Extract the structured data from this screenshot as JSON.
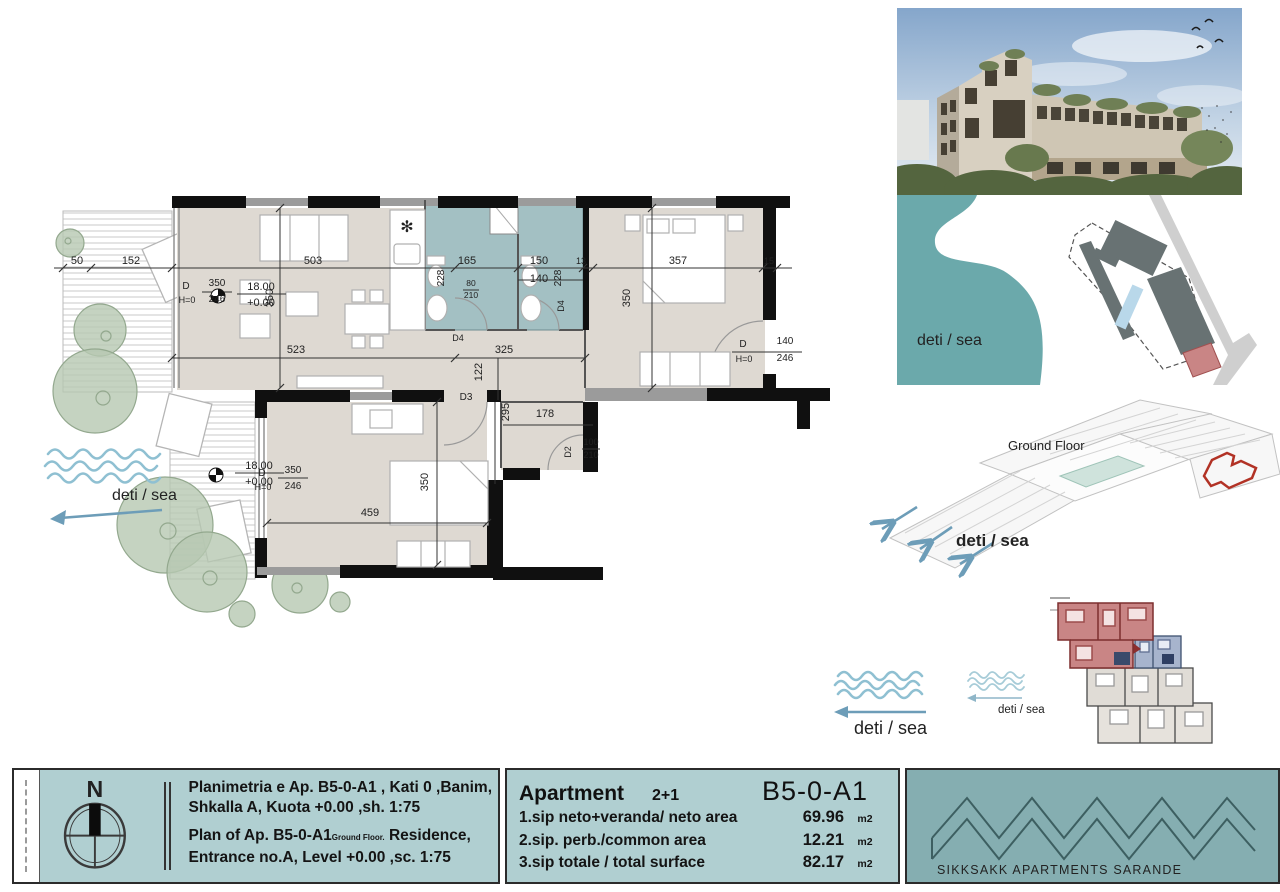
{
  "plan": {
    "deti_sea": "deti / sea",
    "dim_labels": [
      {
        "t": "50",
        "x": 37,
        "y": 78
      },
      {
        "t": "152",
        "x": 91,
        "y": 78
      },
      {
        "t": "503",
        "x": 273,
        "y": 78
      },
      {
        "t": "165",
        "x": 427,
        "y": 78
      },
      {
        "t": "228",
        "x": 404,
        "y": 92,
        "r": -90,
        "fs": 10
      },
      {
        "t": "150",
        "x": 499,
        "y": 78
      },
      {
        "t": "140",
        "x": 499,
        "y": 96
      },
      {
        "t": "228",
        "x": 521,
        "y": 92,
        "r": -90,
        "fs": 10
      },
      {
        "t": "13",
        "x": 541,
        "y": 78,
        "fs": 9
      },
      {
        "t": "357",
        "x": 638,
        "y": 78
      },
      {
        "t": "15",
        "x": 729,
        "y": 78,
        "fs": 9
      },
      {
        "t": "350",
        "x": 233,
        "y": 112,
        "r": -90
      },
      {
        "t": "350",
        "x": 590,
        "y": 112,
        "r": -90
      },
      {
        "t": "523",
        "x": 256,
        "y": 167
      },
      {
        "t": "325",
        "x": 464,
        "y": 167
      },
      {
        "t": "122",
        "x": 442,
        "y": 186,
        "r": -90
      },
      {
        "t": "295",
        "x": 469,
        "y": 226,
        "r": -90
      },
      {
        "t": "178",
        "x": 505,
        "y": 231
      },
      {
        "t": "459",
        "x": 330,
        "y": 330
      },
      {
        "t": "350",
        "x": 388,
        "y": 296,
        "r": -90
      },
      {
        "t": "18.00",
        "x": 221,
        "y": 104
      },
      {
        "t": "+0.00",
        "x": 221,
        "y": 120
      },
      {
        "t": "18.00",
        "x": 219,
        "y": 283
      },
      {
        "t": "+0.00",
        "x": 219,
        "y": 299
      },
      {
        "t": "D",
        "x": 146,
        "y": 103,
        "fs": 10
      },
      {
        "t": "350",
        "x": 177,
        "y": 100,
        "fs": 10
      },
      {
        "t": "H=0",
        "x": 147,
        "y": 117,
        "fs": 9
      },
      {
        "t": "246",
        "x": 177,
        "y": 116,
        "fs": 10
      },
      {
        "t": "D",
        "x": 222,
        "y": 290,
        "fs": 10
      },
      {
        "t": "350",
        "x": 253,
        "y": 287,
        "fs": 10
      },
      {
        "t": "H=0",
        "x": 223,
        "y": 304,
        "fs": 9
      },
      {
        "t": "246",
        "x": 253,
        "y": 303,
        "fs": 10
      },
      {
        "t": "D",
        "x": 703,
        "y": 161,
        "fs": 10
      },
      {
        "t": "140",
        "x": 745,
        "y": 158,
        "fs": 10
      },
      {
        "t": "H=0",
        "x": 704,
        "y": 176,
        "fs": 9
      },
      {
        "t": "246",
        "x": 745,
        "y": 175,
        "fs": 10
      },
      {
        "t": "80",
        "x": 431,
        "y": 100,
        "fs": 8.5
      },
      {
        "t": "210",
        "x": 431,
        "y": 112,
        "fs": 8.5
      },
      {
        "t": "D4",
        "x": 418,
        "y": 155,
        "fs": 9
      },
      {
        "t": "D4",
        "x": 524,
        "y": 120,
        "r": -90,
        "fs": 9
      },
      {
        "t": "D3",
        "x": 426,
        "y": 214,
        "fs": 10
      },
      {
        "t": "D2",
        "x": 531,
        "y": 266,
        "r": -90,
        "fs": 9
      },
      {
        "t": "100",
        "x": 551,
        "y": 259,
        "fs": 9
      },
      {
        "t": "210",
        "x": 551,
        "y": 272,
        "fs": 9
      }
    ]
  },
  "map": {
    "label": "deti / sea"
  },
  "axon": {
    "label": "deti / sea",
    "watermark": "Ground Floor"
  },
  "waves": {
    "large_label": "deti / sea",
    "small_label": "deti / sea"
  },
  "titleblock": {
    "north": "N",
    "line1_sq": "Planimetria e Ap. B5-0-A1 , Kati 0 ,Banim,",
    "line2_sq": "Shkalla A, Kuota +0.00 ,sh.  1:75",
    "line3_en_a": "Plan of Ap. B5-0-A1",
    "line3_en_small": "Ground Floor.",
    "line3_en_b": " Residence,",
    "line4_en": "Entrance no.A, Level +0.00 ,sc.   1:75",
    "apartment_label": "Apartment",
    "apartment_type": "2+1",
    "unit_code": "B5-0-A1",
    "rows": [
      {
        "label": "1.sip neto+veranda/ neto area",
        "value": "69.96",
        "unit": "m2"
      },
      {
        "label": "2.sip. perb./common area",
        "value": "12.21",
        "unit": "m2"
      },
      {
        "label": "3.sip totale / total surface",
        "value": "82.17",
        "unit": "m2"
      }
    ],
    "logo_text": "SIKKSAKK APARTMENTS SARANDE"
  },
  "colors": {
    "titleblock_bg": "#b0cfd1",
    "logo_bg": "#85aeb1",
    "border_dark": "#2b2b2b",
    "floor_fill": "#ded9d2",
    "bath_fill": "#a3c0c3",
    "sea_fill": "#6ba9ab",
    "tree_fill": "#b7c8b2",
    "wave_blue": "#8fc0d2",
    "arrow_blue": "#6d9db8",
    "highlight_red": "#c98585",
    "plan_blue": "#a7b4cd",
    "site_building": "#687273",
    "wall_black": "#101010"
  }
}
